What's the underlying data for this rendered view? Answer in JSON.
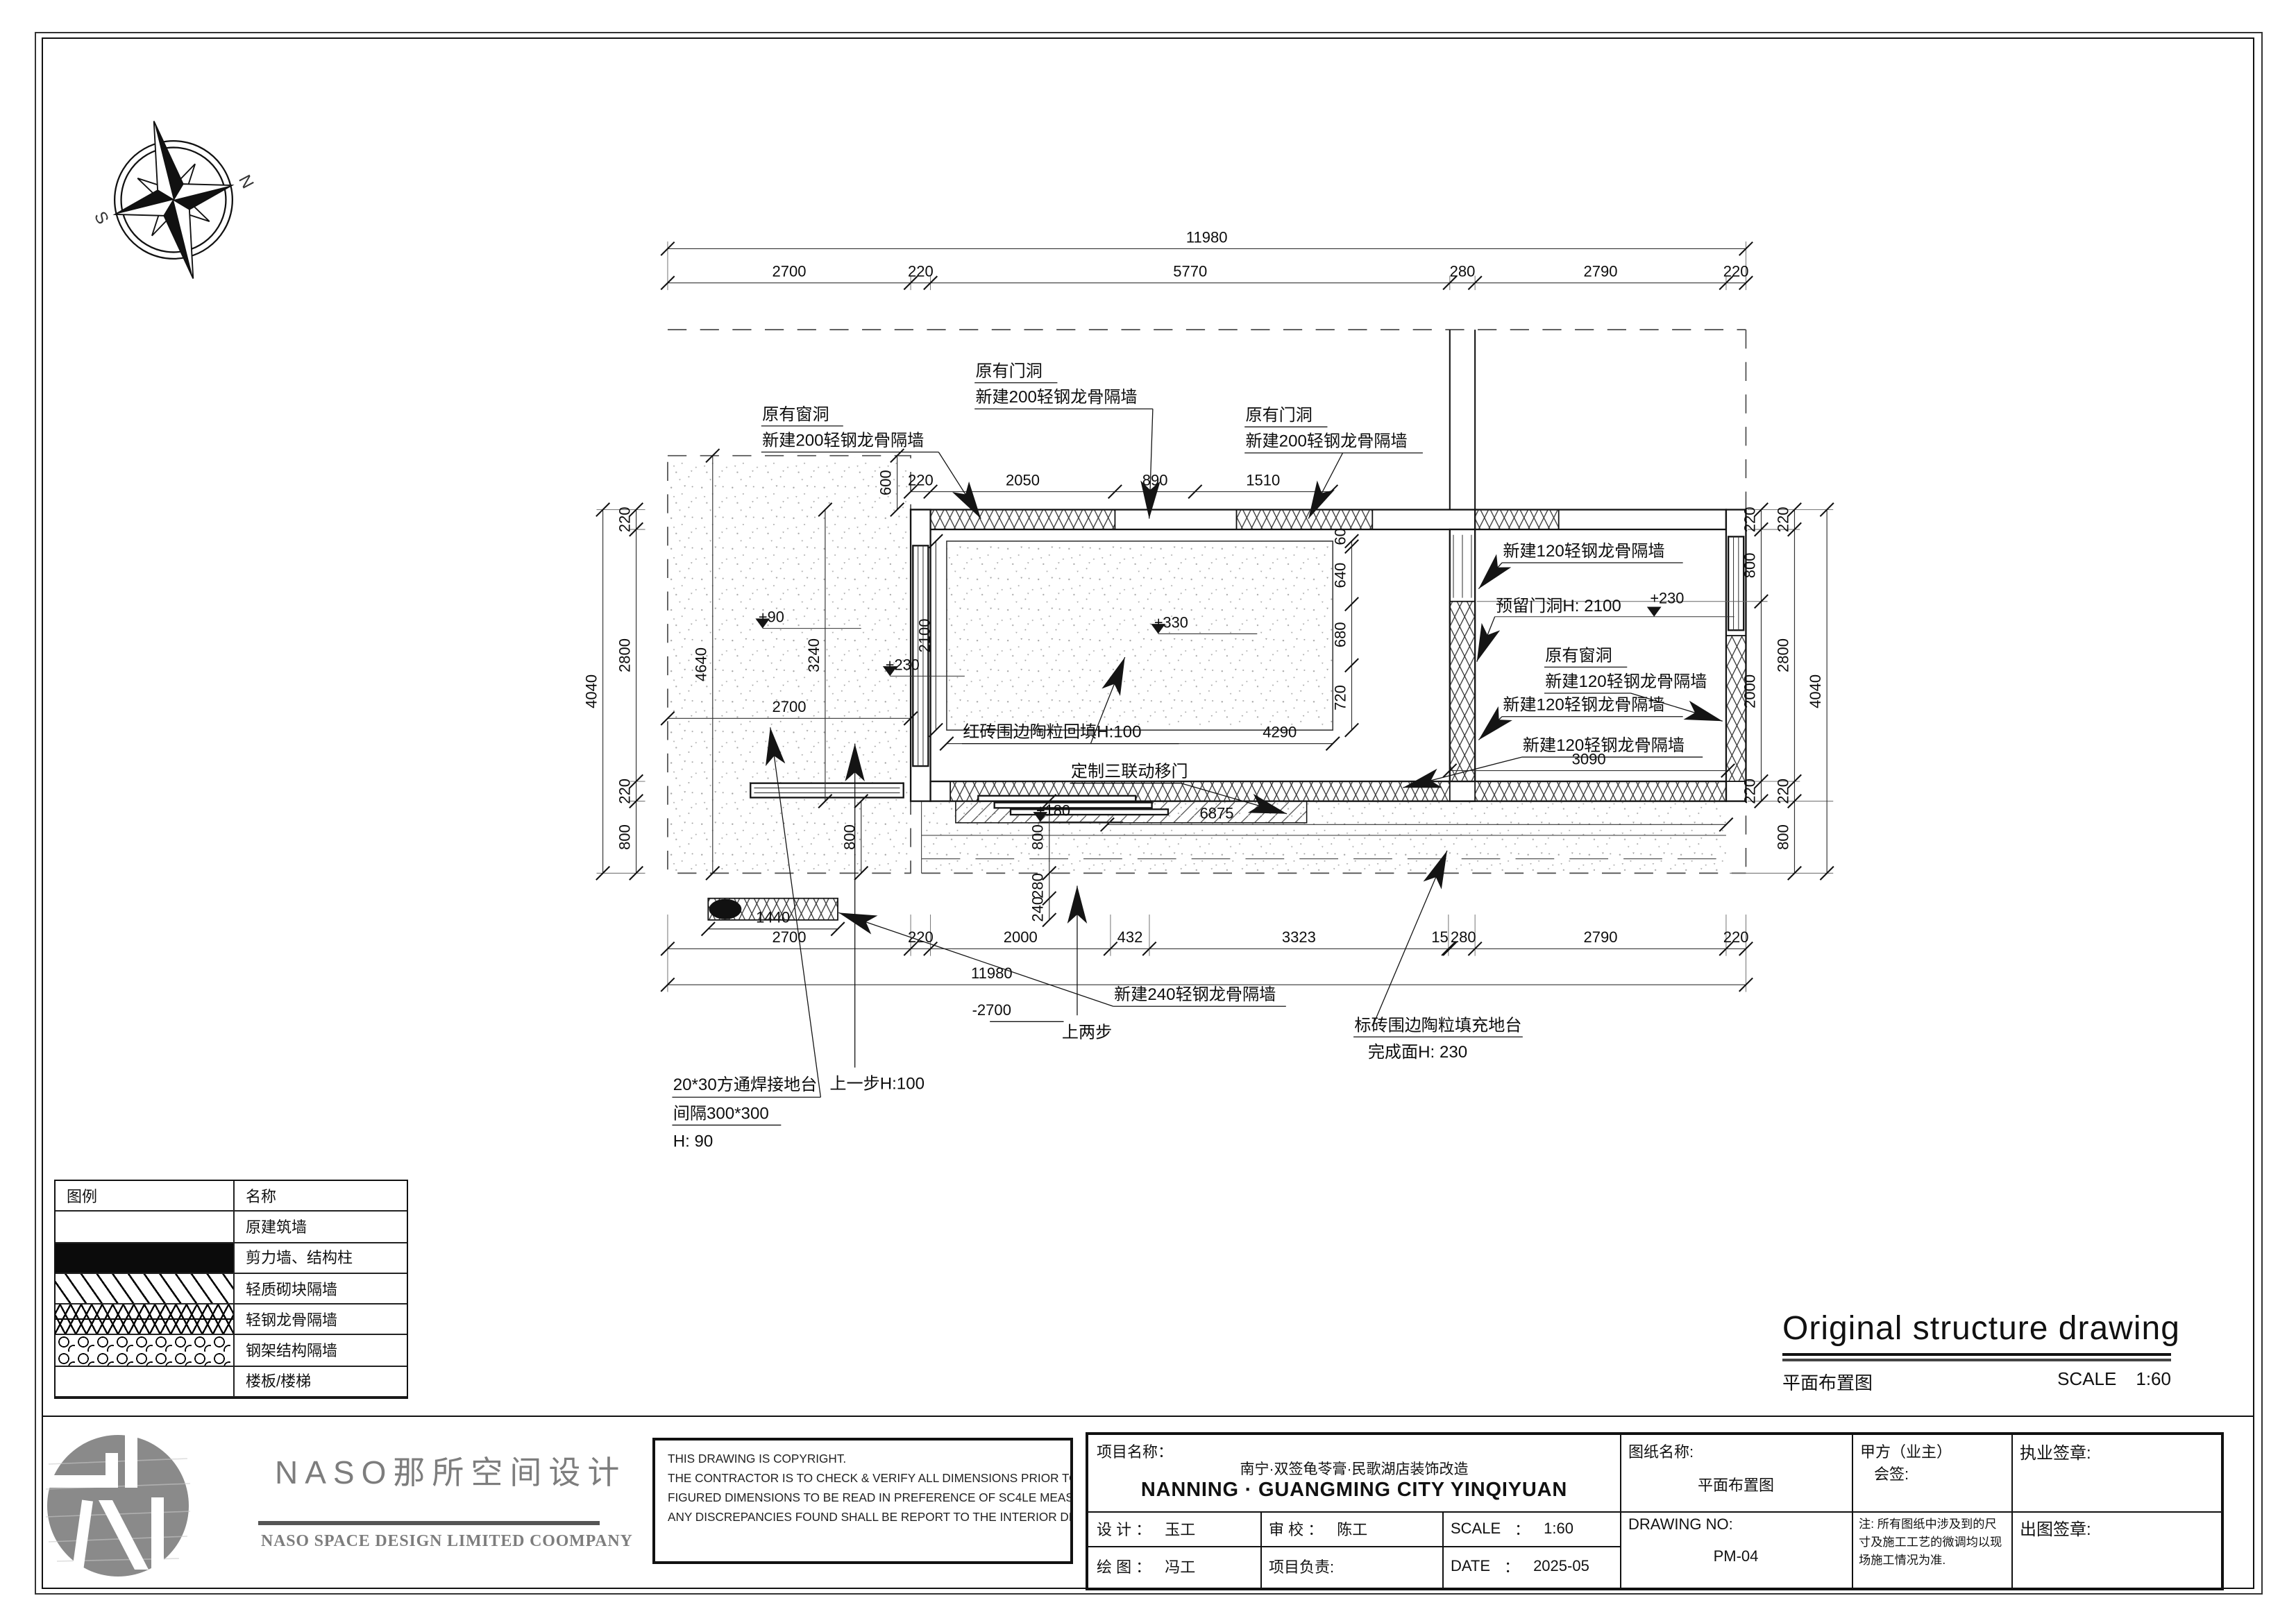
{
  "compass": {
    "north": "N",
    "south": "S"
  },
  "legend": {
    "header_symbol": "图例",
    "header_name": "名称",
    "rows": [
      {
        "name": "原建筑墙"
      },
      {
        "name": "剪力墙、结构柱"
      },
      {
        "name": "轻质砌块隔墙"
      },
      {
        "name": "轻钢龙骨隔墙"
      },
      {
        "name": "钢架结构隔墙"
      },
      {
        "name": "楼板/楼梯"
      }
    ]
  },
  "drawing_title": {
    "en": "Original structure drawing",
    "cn": "平面布置图",
    "scale_label": "SCALE",
    "scale_value": "1:60"
  },
  "plan": {
    "dims": {
      "top_total": "11980",
      "bottom_total": "11980",
      "top_row": [
        "2700",
        "220",
        "5770",
        "280",
        "2790",
        "220"
      ],
      "bottom_row": [
        "2700",
        "220",
        "2000",
        "432",
        "3323",
        "15",
        "280",
        "2790",
        "220"
      ],
      "upper_inner": [
        "220",
        "2050",
        "890",
        "1510"
      ],
      "dim_600": "600",
      "left_outer": "4040",
      "left_col": [
        "220",
        "2800",
        "220",
        "800"
      ],
      "right_inner_col": [
        "220",
        "800",
        "2000",
        "220"
      ],
      "right_outer_col": [
        "220",
        "2800",
        "220",
        "800"
      ],
      "right_far": "4040",
      "slab_h": "4640",
      "room_h": "3240",
      "slab_w": "2700",
      "pad_h": "2100",
      "pad_w": "4290",
      "pad_right": [
        "60",
        "640",
        "680",
        "720"
      ],
      "step_h": "800",
      "stack": [
        "800",
        "280",
        "240"
      ],
      "wall240_len": "1440",
      "room2_w": "3090",
      "platform_w": "6875",
      "neg": "-2700"
    },
    "levels": {
      "slab": "+90",
      "pad": "+330",
      "left": "+230",
      "right": "+230",
      "platform": "+180"
    },
    "notes": {
      "win_top_1": "原有窗洞",
      "win_top_2": "新建200轻钢龙骨隔墙",
      "door1_1": "原有门洞",
      "door1_2": "新建200轻钢龙骨隔墙",
      "door2_1": "原有门洞",
      "door2_2": "新建200轻钢龙骨隔墙",
      "wall120_a": "新建120轻钢龙骨隔墙",
      "reserved_door": "预留门洞H: 2100",
      "win120_1": "原有窗洞",
      "win120_2": "新建120轻钢龙骨隔墙",
      "wall120_b": "新建120轻钢龙骨隔墙",
      "wall120_c": "新建120轻钢龙骨隔墙",
      "pad_fill": "红砖围边陶粒回填H:100",
      "sliding_door": "定制三联动移门",
      "steps2": "上两步",
      "platform_1": "标砖围边陶粒填充地台",
      "platform_2": "完成面H: 230",
      "wall240": "新建240轻钢龙骨隔墙",
      "step1": "上一步H:100",
      "ground_1": "20*30方通焊接地台",
      "ground_2": "间隔300*300",
      "ground_3": "H: 90"
    }
  },
  "footer": {
    "company_cn": "NASO那所空间设计",
    "company_en": "NASO SPACE DESIGN LIMITED COOMPANY",
    "copyright": [
      "THIS DRAWING IS COPYRIGHT.",
      "THE CONTRACTOR IS TO CHECK & VERIFY ALL DIMENSIONS PRIOR TO PROCEEDING WORK.",
      "FIGURED DIMENSIONS TO BE READ IN PREFERENCE OF SC4LE MEASUREMENT.",
      "ANY DISCREPANCIES FOUND SHALL BE REPORT TO THE INTERIOR DESIGNER."
    ],
    "project_label": "项目名称",
    "project_colon": "：",
    "project_cn": "南宁·双签龟苓膏·民歌湖店装饰改造",
    "project_en": "NANNING · GUANGMING CITY YINQIYUAN",
    "design_label": "设 计 ：",
    "design_value": "玉工",
    "check_label": "审 校 ：",
    "check_value": "陈工",
    "scale_label": "SCALE",
    "scale_colon": "：",
    "scale_value": "1:60",
    "draw_label": "绘 图 ：",
    "draw_value": "冯工",
    "lead_label": "项目负责:",
    "date_label": "DATE",
    "date_colon": "：",
    "date_value": "2025-05",
    "sheet_name_label": "图纸名称:",
    "sheet_name": "平面布置图",
    "drawing_no_label": "DRAWING NO:",
    "drawing_no": "PM-04",
    "party_1": "甲方（业主）",
    "party_2": "会签:",
    "note": "注: 所有图纸中涉及到的尺寸及施工工艺的微调均以现场施工情况为准.",
    "stamp_license": "执业签章:",
    "stamp_issue": "出图签章:"
  }
}
